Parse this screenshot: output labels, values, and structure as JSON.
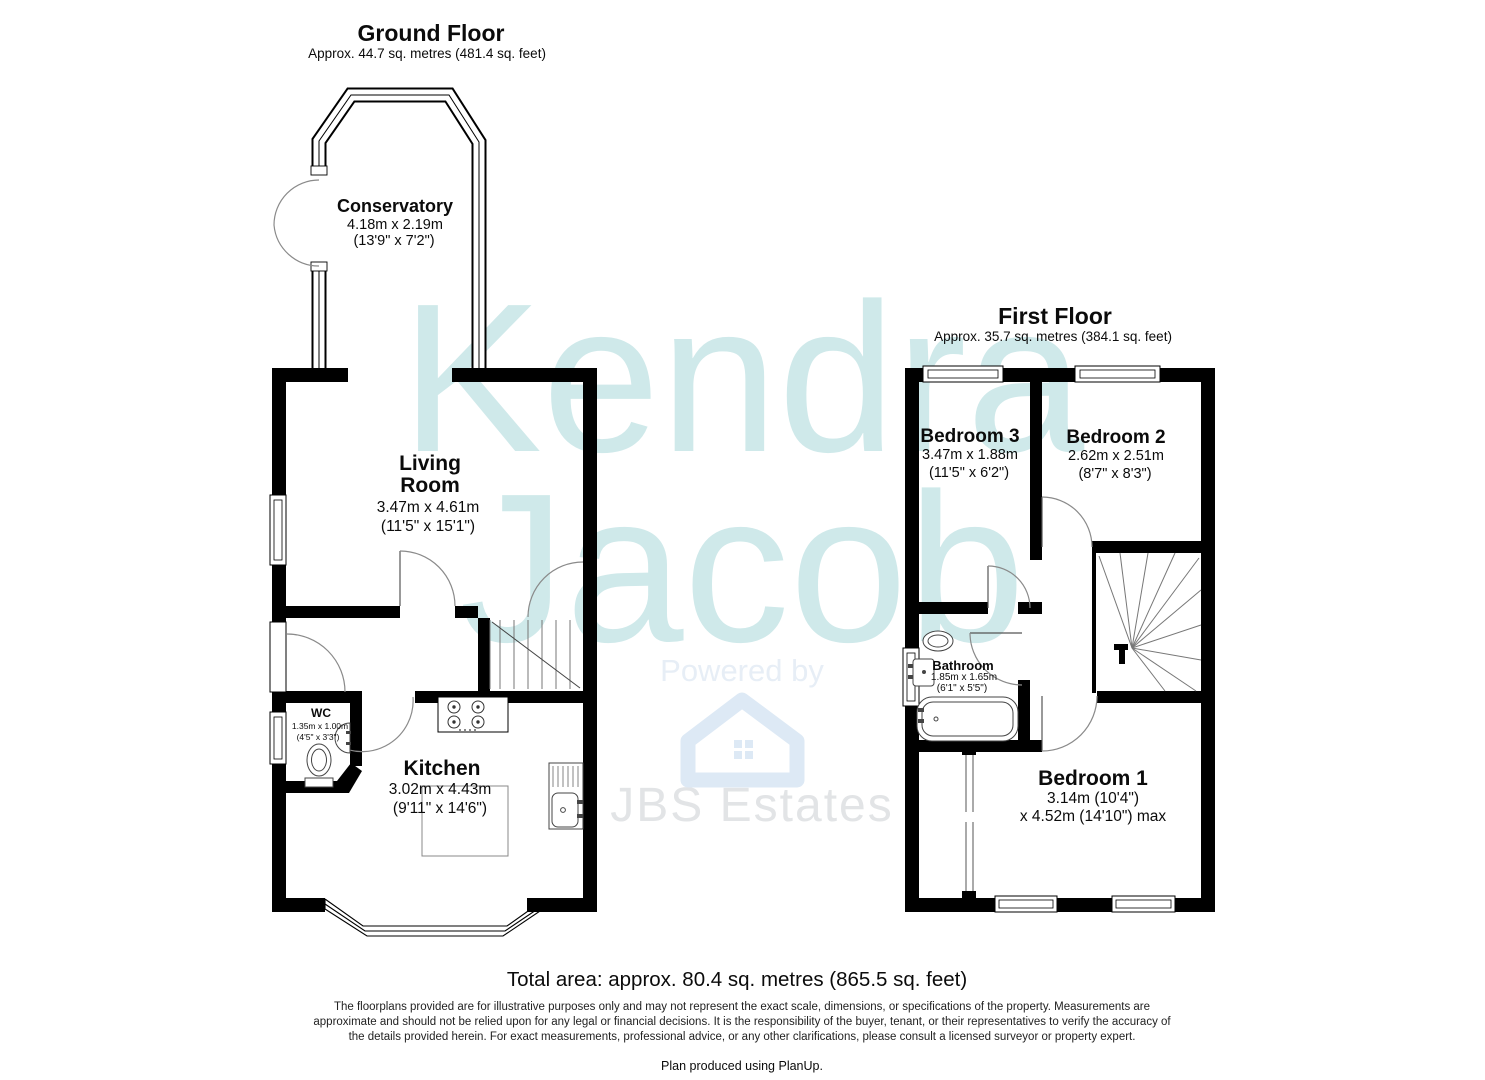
{
  "watermark": {
    "line1": "Kendra",
    "line2": "Jacob",
    "powered_by": "Powered by",
    "brand": "JBS Estates"
  },
  "ground_floor": {
    "title": "Ground Floor",
    "subtitle": "Approx. 44.7 sq. metres (481.4 sq. feet)",
    "rooms": {
      "conservatory": {
        "name": "Conservatory",
        "dim_m": "4.18m x 2.19m",
        "dim_ft": "(13'9\" x 7'2\")"
      },
      "living_room": {
        "name_line1": "Living",
        "name_line2": "Room",
        "dim_m": "3.47m x 4.61m",
        "dim_ft": "(11'5\" x 15'1\")"
      },
      "wc": {
        "name": "WC",
        "dim_m": "1.35m x 1.00m",
        "dim_ft": "(4'5\" x 3'3\")"
      },
      "kitchen": {
        "name": "Kitchen",
        "dim_m": "3.02m x 4.43m",
        "dim_ft": "(9'11\" x 14'6\")"
      }
    }
  },
  "first_floor": {
    "title": "First Floor",
    "subtitle": "Approx. 35.7 sq. metres (384.1 sq. feet)",
    "rooms": {
      "bedroom3": {
        "name": "Bedroom 3",
        "dim_m": "3.47m x 1.88m",
        "dim_ft": "(11'5\" x 6'2\")"
      },
      "bedroom2": {
        "name": "Bedroom 2",
        "dim_m": "2.62m x 2.51m",
        "dim_ft": "(8'7\" x 8'3\")"
      },
      "bathroom": {
        "name": "Bathroom",
        "dim_m": "1.85m x 1.65m",
        "dim_ft": "(6'1\" x 5'5\")"
      },
      "bedroom1": {
        "name": "Bedroom 1",
        "dim_line1": "3.14m (10'4\")",
        "dim_line2": "x 4.52m (14'10\") max"
      }
    }
  },
  "footer": {
    "total_area": "Total area: approx. 80.4 sq. metres (865.5 sq. feet)",
    "disclaimer_lines": [
      "The floorplans provided are for illustrative purposes only and may not represent the exact scale, dimensions, or specifications of the property. Measurements are",
      "approximate and should not be relied upon for any legal or financial decisions. It is the responsibility of the buyer, tenant, or their representatives to verify the accuracy of",
      "the details provided herein.  For exact measurements, professional advice, or any other clarifications, please consult a licensed surveyor or property expert."
    ],
    "produced_by": "Plan produced using PlanUp."
  },
  "colors": {
    "wall": "#000000",
    "watermark_text": "#cfe9ea",
    "powered_text": "#e7eef6",
    "brand_text": "#e2e4e6",
    "house_icon": "#dde9f5",
    "door_arc": "#8a8a8a"
  }
}
